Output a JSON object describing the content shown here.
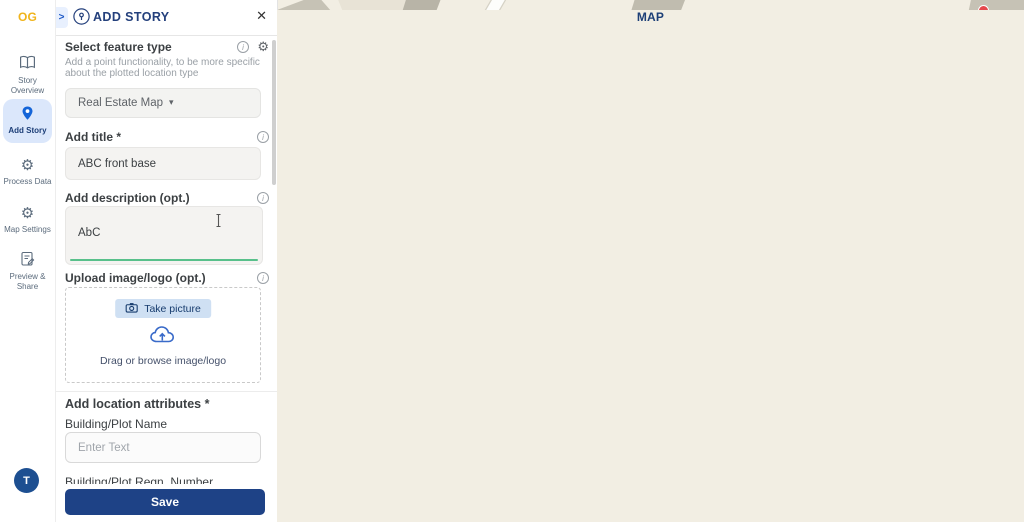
{
  "brand": {
    "map": "MAP",
    "og": "OG"
  },
  "sidebar": {
    "items": [
      {
        "label": "Story Overview"
      },
      {
        "label": "Add Story"
      },
      {
        "label": "Process Data"
      },
      {
        "label": "Map Settings"
      },
      {
        "label": "Preview & Share"
      }
    ],
    "avatar": "T"
  },
  "panel": {
    "chevron": ">",
    "title": "ADD STORY",
    "close": "✕",
    "feature": {
      "label": "Select feature type",
      "help_line1": "Add a point functionality, to be more specific",
      "help_line2": "about the plotted location type",
      "value": "Real Estate Map",
      "caret": "▾",
      "gear": "⚙"
    },
    "title_field": {
      "label": "Add title *",
      "value": "ABC front base"
    },
    "description_field": {
      "label": "Add description (opt.)",
      "value": "AbC"
    },
    "upload": {
      "label": "Upload image/logo (opt.)",
      "take_picture": "Take picture",
      "drag_text": "Drag or browse image/logo"
    },
    "attributes": {
      "label": "Add location attributes *",
      "field_label": "Building/Plot Name",
      "placeholder": "Enter Text",
      "clipped_label": "Building/Plot Regn. Number"
    },
    "save_label": "Save",
    "info_glyph": "i"
  },
  "sidebar_icons": {
    "process_gear": "⚙",
    "settings_gear": "⚙"
  },
  "map": {
    "road1": "Nilomani Phukan Path",
    "road2": "G.S. Road",
    "zoom_in": "+",
    "zoom_out": "−",
    "base_map_label": "Base Map",
    "attribution_label": "Attribution",
    "attribution_info": "i",
    "credits": "© MapTiler © OpenStreetMap contributors",
    "consult_line1": "Free 15-min Map",
    "consult_line2": "Consultation",
    "edit_close": "✕",
    "edit_pencil": "✎"
  },
  "colors": {
    "brand_navy": "#1d3f77",
    "brand_yellow": "#f0b41c",
    "accent_blue": "#1565d8",
    "save_blue": "#1e4286",
    "active_item_bg": "#dbe7fb",
    "green_underline": "#58c08b",
    "map_bg": "#f2eee3",
    "building": "#e8e3d6",
    "building_gray": "#c6c2b5",
    "building_dark": "#b0ac9f",
    "road_yellow": "#f7e8a0",
    "plotted_polygon": "#3d4f6e",
    "consult_bg": "#0c1f3e",
    "chat_blue": "#2e6be0",
    "badge_red": "#e5484d"
  }
}
